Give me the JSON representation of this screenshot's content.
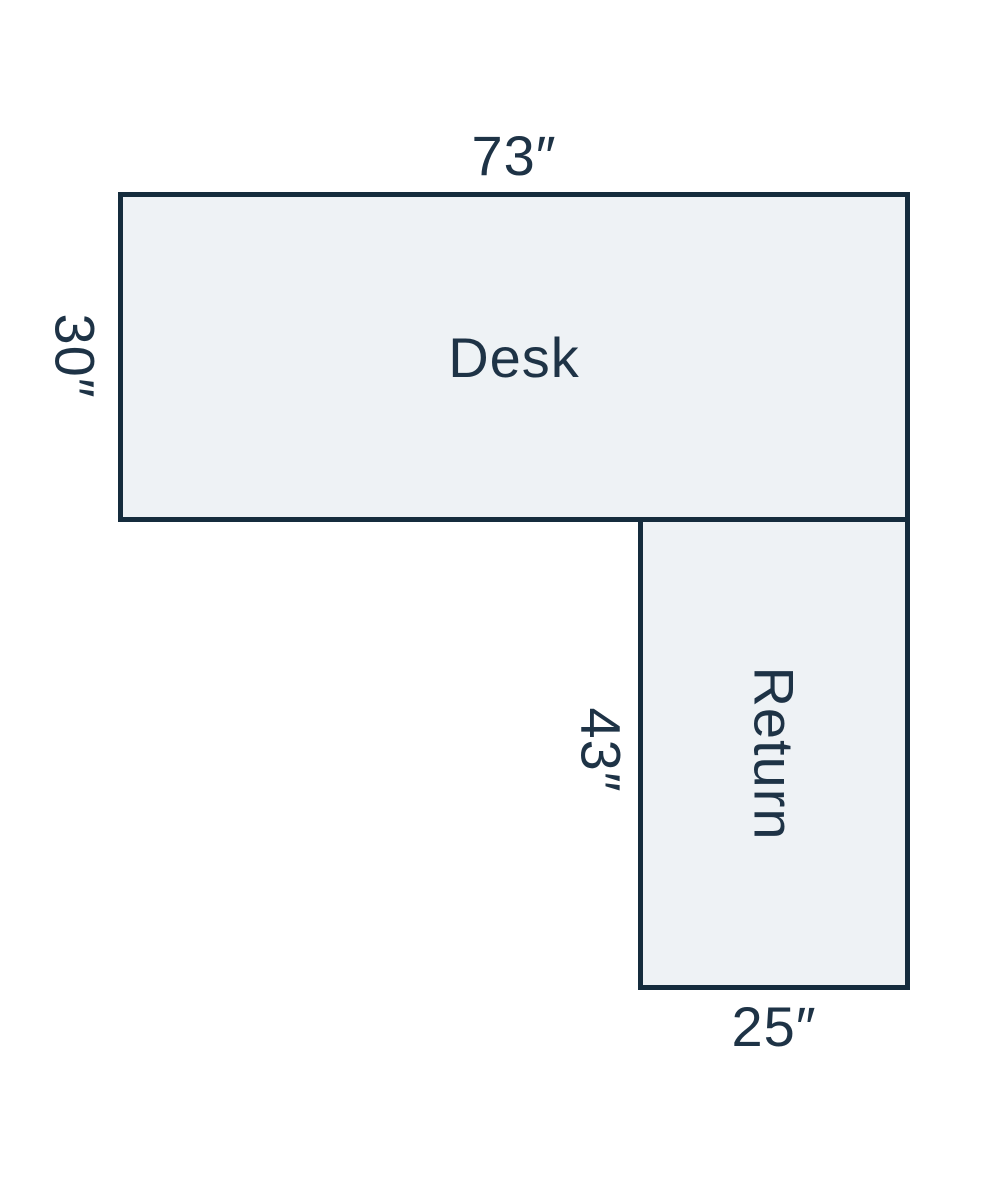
{
  "colors": {
    "outline": "#152c3d",
    "fill": "#eef2f5",
    "text": "#1e3346",
    "background": "#ffffff"
  },
  "diagram": {
    "desk": {
      "label": "Desk",
      "width_label": "73″",
      "depth_label": "30″"
    },
    "return": {
      "label": "Return",
      "length_label": "43″",
      "width_label": "25″"
    }
  }
}
